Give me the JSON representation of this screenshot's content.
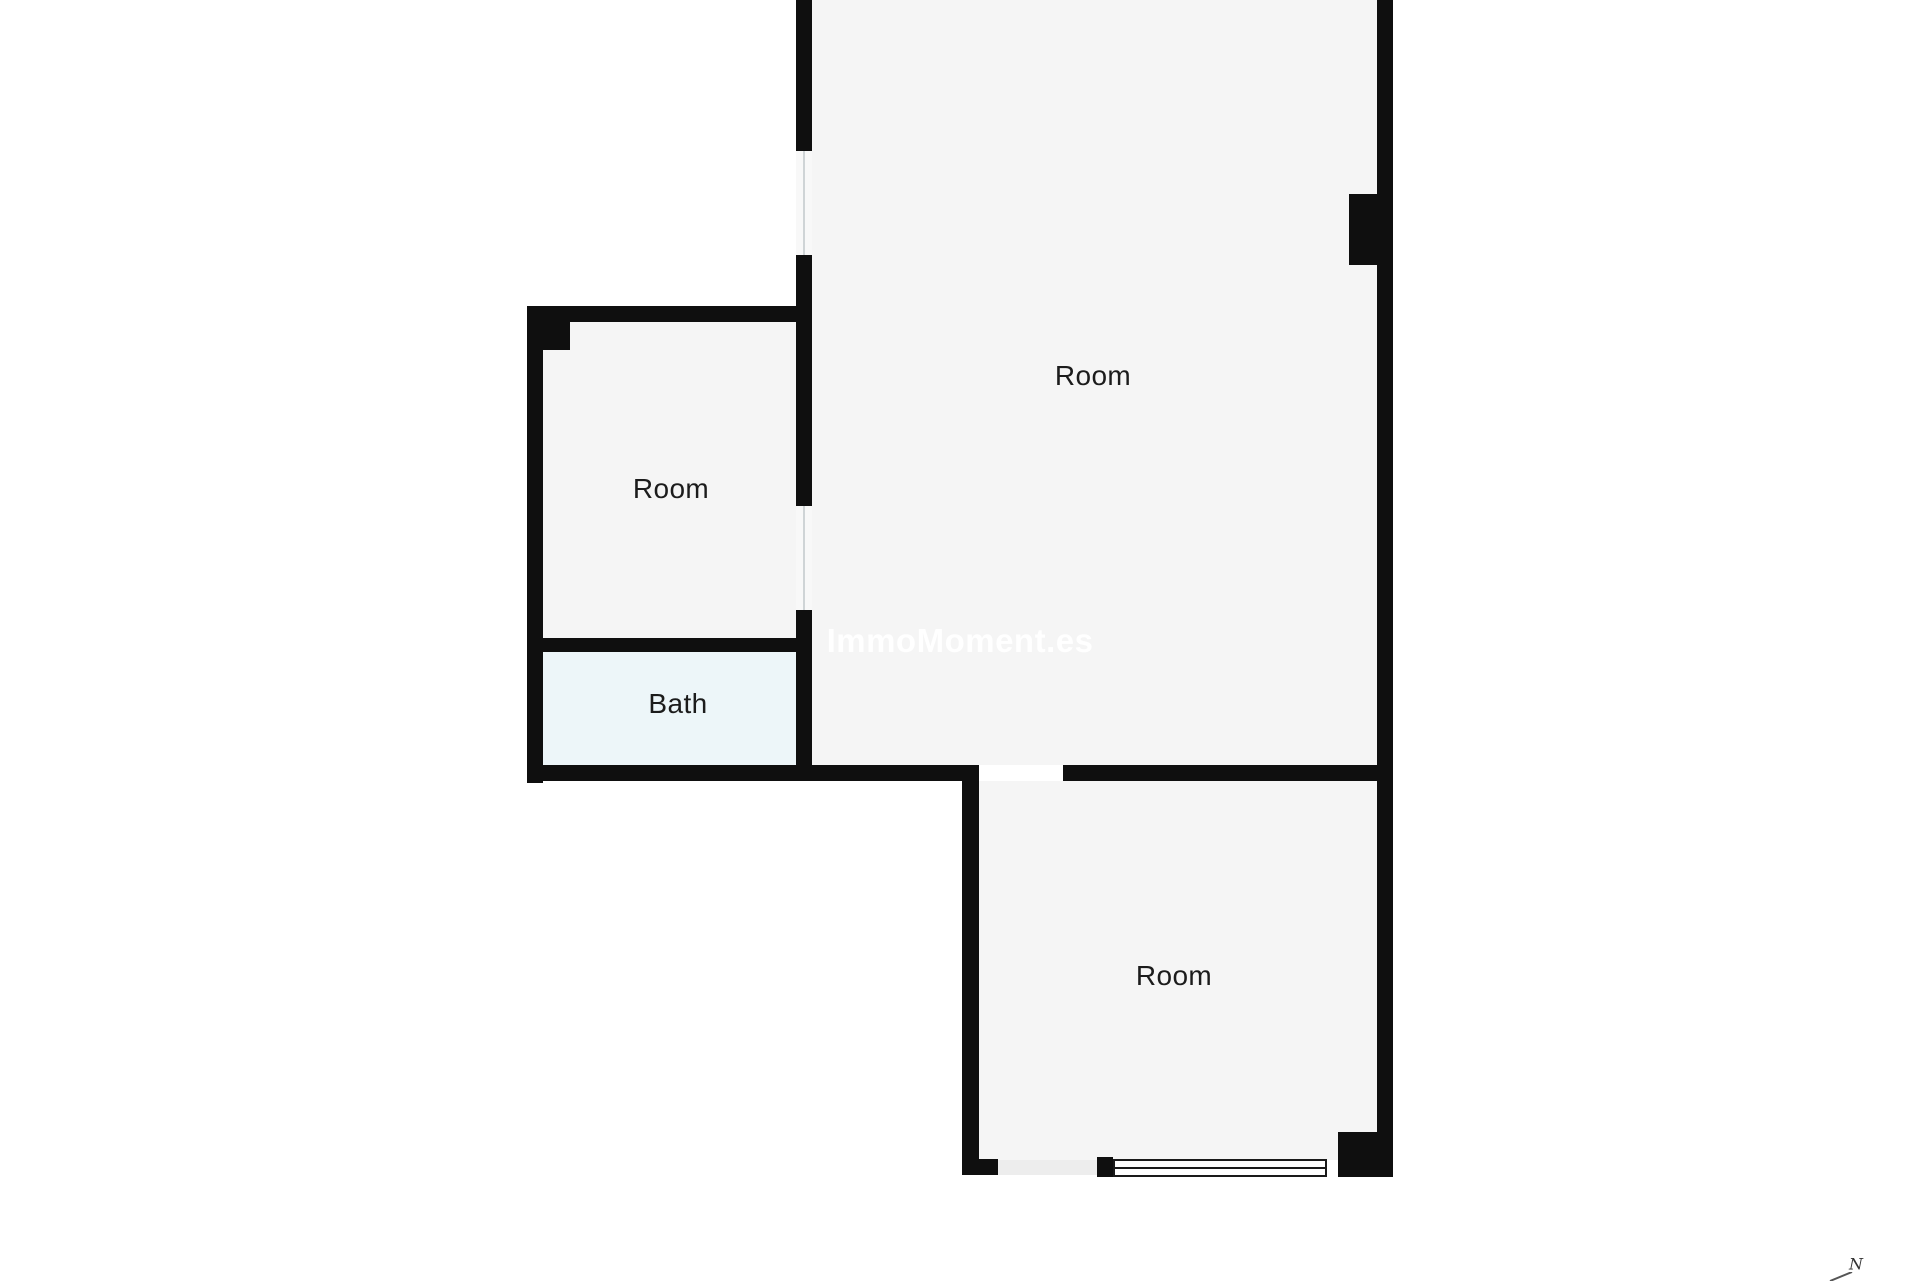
{
  "colors": {
    "background": "#ffffff",
    "floor": "#f5f5f5",
    "bath": "#edf6f9",
    "wall": "#0f0f0f",
    "label": "#1c1c1c",
    "watermark": "rgba(255,255,255,0.92)",
    "window_gap": "#f8f8f8",
    "window_line": "#cfd4d6",
    "frame": "#1a1a1a",
    "opening": "#ededed",
    "door_gap": "#ffffff"
  },
  "watermark": {
    "text": "ImmoMoment.es"
  },
  "north": {
    "label": "N"
  },
  "rooms": [
    {
      "id": "room-top",
      "label": "Room",
      "fill": "floor",
      "rect": [
        812,
        0,
        565,
        765
      ],
      "label_pos": [
        1093,
        376
      ]
    },
    {
      "id": "room-left",
      "label": "Room",
      "fill": "floor",
      "rect": [
        543,
        322,
        253,
        316
      ],
      "label_pos": [
        671,
        489
      ]
    },
    {
      "id": "bath",
      "label": "Bath",
      "fill": "bath",
      "rect": [
        543,
        652,
        253,
        113
      ],
      "label_pos": [
        678,
        704
      ]
    },
    {
      "id": "room-bottom",
      "label": "Room",
      "fill": "floor",
      "rect": [
        979,
        778,
        398,
        382
      ],
      "label_pos": [
        1174,
        976
      ]
    }
  ],
  "walls": [
    {
      "id": "wall-main-left-upper",
      "rect": [
        796,
        0,
        16,
        151
      ]
    },
    {
      "id": "wall-main-left-middle",
      "rect": [
        796,
        255,
        16,
        251
      ]
    },
    {
      "id": "wall-main-left-lower",
      "rect": [
        796,
        610,
        16,
        171
      ]
    },
    {
      "id": "wall-main-right",
      "rect": [
        1377,
        0,
        16,
        1177
      ]
    },
    {
      "id": "pillar-right-wall",
      "rect": [
        1349,
        194,
        29,
        71
      ]
    },
    {
      "id": "wall-leftroom-top",
      "rect": [
        527,
        306,
        285,
        16
      ]
    },
    {
      "id": "pillar-leftroom-corner",
      "rect": [
        527,
        306,
        43,
        44
      ]
    },
    {
      "id": "wall-outer-left",
      "rect": [
        527,
        306,
        16,
        477
      ]
    },
    {
      "id": "wall-bath-divider",
      "rect": [
        527,
        638,
        285,
        14
      ]
    },
    {
      "id": "wall-bottom-left-section",
      "rect": [
        527,
        765,
        452,
        16
      ]
    },
    {
      "id": "wall-bottom-right-section",
      "rect": [
        1063,
        765,
        330,
        16
      ]
    },
    {
      "id": "wall-bottomroom-left",
      "rect": [
        962,
        778,
        17,
        397
      ]
    },
    {
      "id": "wall-bottomroom-stub",
      "rect": [
        962,
        1159,
        36,
        16
      ]
    },
    {
      "id": "wall-bottom-block",
      "rect": [
        1097,
        1157,
        16,
        20
      ]
    },
    {
      "id": "pillar-bottom-right",
      "rect": [
        1338,
        1132,
        55,
        45
      ]
    }
  ],
  "windows": [
    {
      "id": "window-left-upper",
      "type": "gap-v",
      "rect": [
        796,
        151,
        16,
        104
      ]
    },
    {
      "id": "window-left-lower",
      "type": "gap-v",
      "rect": [
        796,
        506,
        16,
        104
      ]
    },
    {
      "id": "window-bottom",
      "type": "framed-h",
      "rect": [
        1113,
        1159,
        214,
        18
      ]
    }
  ],
  "openings": [
    {
      "id": "door-gap-bottomroom",
      "fill": "door_gap",
      "rect": [
        979,
        765,
        84,
        16
      ]
    },
    {
      "id": "opening-bottom-edge",
      "fill": "opening",
      "rect": [
        998,
        1160,
        99,
        15
      ]
    }
  ]
}
